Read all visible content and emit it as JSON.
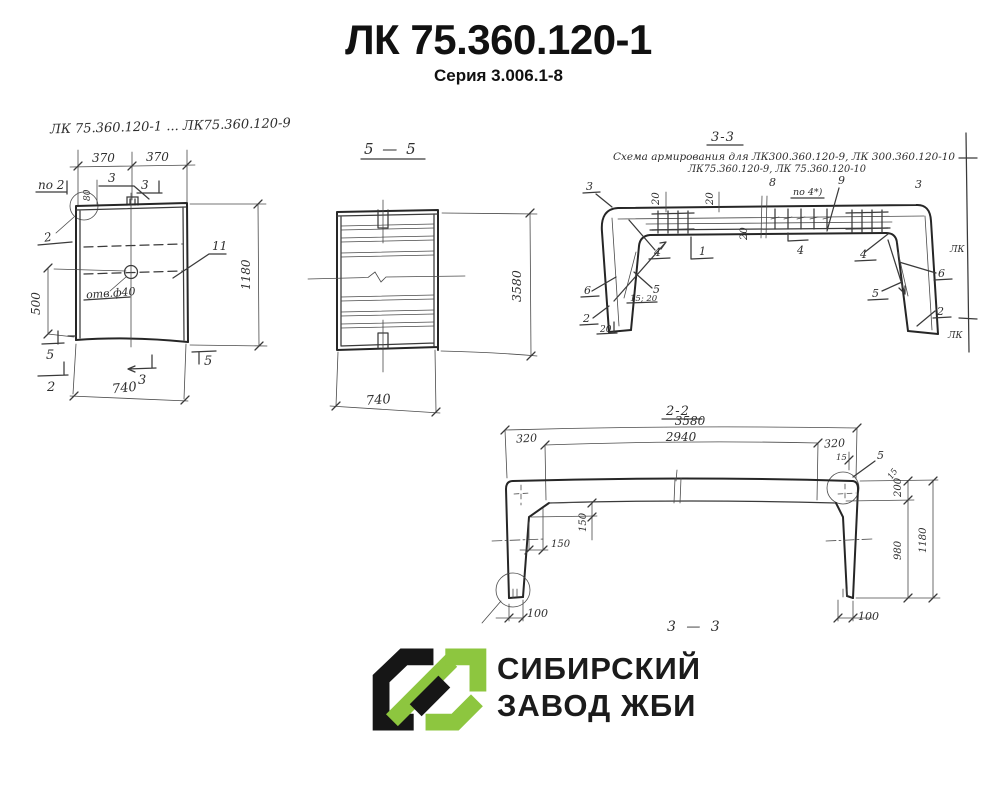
{
  "header": {
    "title": "ЛК 75.360.120-1",
    "subtitle": "Серия 3.006.1-8"
  },
  "colors": {
    "ink": "#3a3a3a",
    "logo_green": "#8dc63f",
    "logo_black": "#161616"
  },
  "view_side": {
    "caption": "ЛК 75.360.120-1 ... ЛК75.360.120-9",
    "dim_370_left": "370",
    "dim_370_right": "370",
    "label_po2": "по 2",
    "dim_80": "80",
    "mark_3_a": "3",
    "mark_3_b": "3",
    "label_detail_2": "2",
    "label_11": "11",
    "label_hole": "отв.ф40",
    "dim_500": "500",
    "dim_1180": "1180",
    "mark_5_left": "5",
    "mark_5_right": "5",
    "mark_2": "2",
    "mark_3": "3",
    "dim_740": "740"
  },
  "view_5_5": {
    "title": "5 — 5",
    "dim_3580": "3580",
    "dim_740": "740"
  },
  "view_3_3": {
    "title": "3-3",
    "subtitle_line1": "Схема армирования для ЛК300.360.120-9, ЛК 300.360.120-10",
    "subtitle_line2": "ЛК75.360.120-9, ЛК 75.360.120-10",
    "mark_3_left": "3",
    "mark_3_right": "3",
    "dim_20_a": "20",
    "dim_20_b": "20",
    "dim_20_c": "20",
    "label_8": "8",
    "label_po4": "по 4*)",
    "label_9": "9",
    "mark_4_flag": "4",
    "label_4_left": "4",
    "label_1": "1",
    "label_6_left": "6",
    "label_5_left": "5",
    "dim_15_20": "15; 20",
    "label_2_left": "2",
    "dim_20_left": "20",
    "label_4_right": "4",
    "label_6_right": "6",
    "label_5_right": "5",
    "label_2_right": "2"
  },
  "view_2_2": {
    "title": "2-2",
    "dim_3580": "3580",
    "dim_2940": "2940",
    "dim_320_left": "320",
    "dim_320_right": "320",
    "dim_15_a": "15",
    "dim_15_b": "15",
    "label_5": "5",
    "dim_200": "200",
    "dim_150_v": "150",
    "dim_150_h": "150",
    "dim_980": "980",
    "dim_1180": "1180",
    "dim_100_left": "100",
    "dim_100_right": "100",
    "footer": "3 — 3"
  },
  "edge_fragment": {
    "label_top": "ЛК",
    "label_bottom": "ЛК"
  },
  "logo": {
    "line1": "СИБИРСКИЙ",
    "line2": "ЗАВОД ЖБИ"
  }
}
